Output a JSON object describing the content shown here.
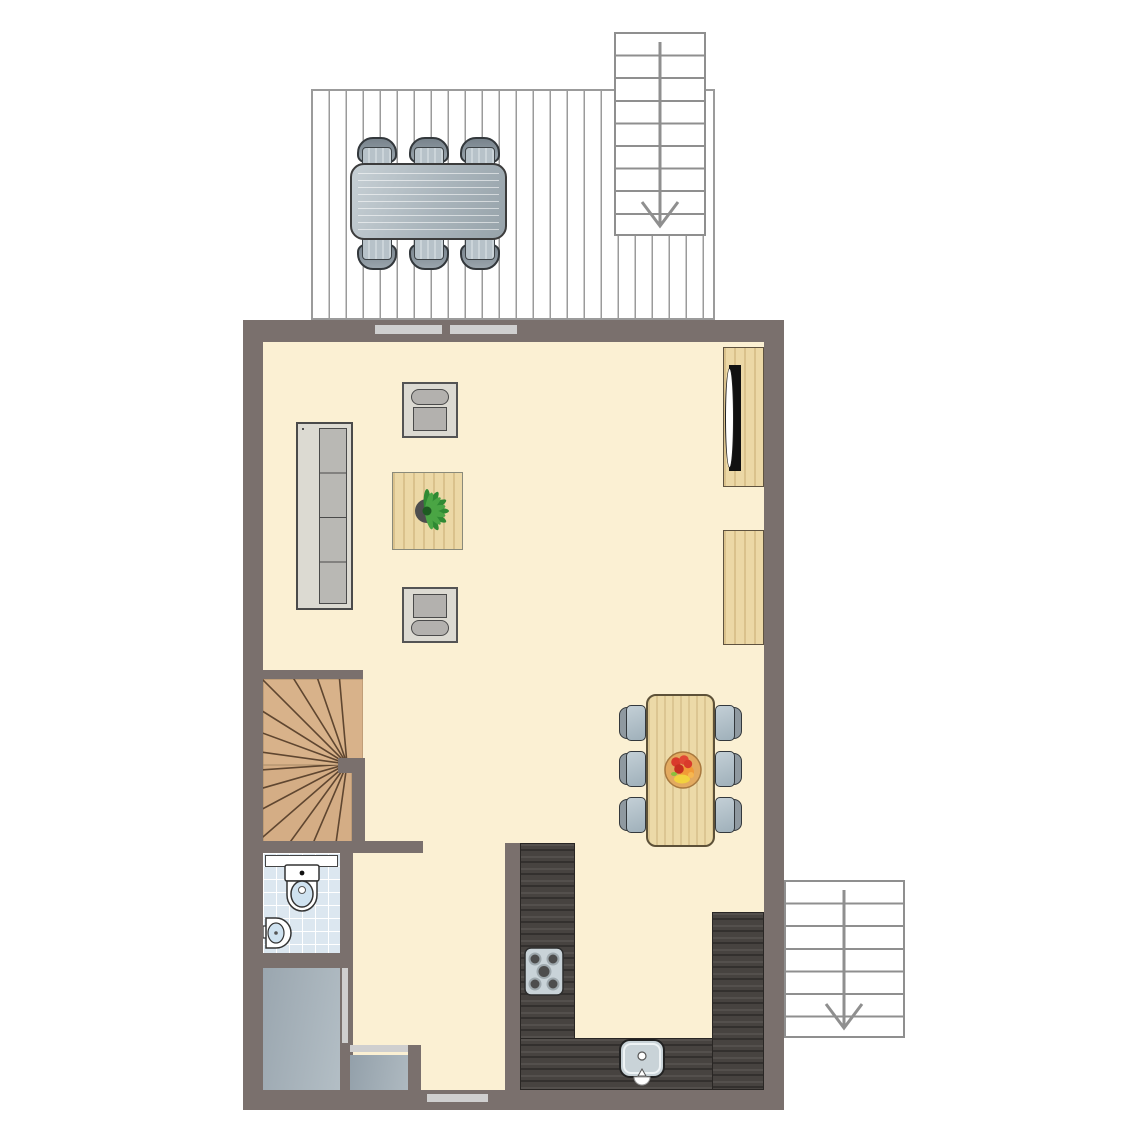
{
  "document": {
    "type": "architectural floor plan, top-down view, single storey",
    "visible_text": [],
    "stair_direction_arrows": "down"
  },
  "palette": {
    "wall": "#7a706d",
    "floor": "#fbf0d3",
    "door": "#cfcfcf",
    "deck_line": "#9b9b9b",
    "stair_outline": "#8f8f8f",
    "wood": "#ecd8a6",
    "tile": "#dce7f0",
    "counter": "#474340",
    "stair_wood": "#d8b28a",
    "stair_tread_line": "#5f4630",
    "storage_floor": "#a5b1ba",
    "outdoor_gray": "#aab5bc",
    "plant_green": "#3d9140",
    "fruit_red": "#d93a2b",
    "fruit_orange": "#f19b37",
    "fruit_yellow": "#f2d23e",
    "bowl_tan": "#e3aa5f",
    "tv_black": "#111111"
  },
  "areas": [
    {
      "name": "deck-terrace",
      "features": [
        "outdoor-dining-table",
        "6-outdoor-chairs",
        "exterior-staircase-down"
      ]
    },
    {
      "name": "living-room",
      "features": [
        "sofa-4-seat",
        "armchair-top",
        "armchair-bottom",
        "coffee-table-with-plant",
        "tv-cabinet",
        "sideboard"
      ]
    },
    {
      "name": "dining-area",
      "features": [
        "dining-table",
        "6-chairs",
        "fruit-bowl"
      ]
    },
    {
      "name": "kitchen",
      "features": [
        "u-shaped-counter",
        "hob-5-burners",
        "sink-with-faucet"
      ]
    },
    {
      "name": "winder-staircase",
      "features": [
        "quarter-turn-winder-treads"
      ]
    },
    {
      "name": "bathroom",
      "features": [
        "toilet",
        "corner-washbasin",
        "shelf",
        "tiled-floor"
      ]
    },
    {
      "name": "storage-room",
      "features": [
        "gray-floor"
      ]
    },
    {
      "name": "small-closet",
      "features": [
        "sliding-door"
      ]
    },
    {
      "name": "hall",
      "features": [
        "entry-door-bottom-wall"
      ]
    },
    {
      "name": "exterior-staircase-bottom-right",
      "features": [
        "down-arrow"
      ]
    }
  ],
  "doors": [
    {
      "name": "deck-sliding-door",
      "location": "top wall, two panels"
    },
    {
      "name": "bathroom-door",
      "location": "bathroom right wall"
    },
    {
      "name": "storage-door",
      "location": "storage right wall"
    },
    {
      "name": "closet-door",
      "location": "closet top edge"
    },
    {
      "name": "entry-door",
      "location": "bottom wall"
    }
  ]
}
